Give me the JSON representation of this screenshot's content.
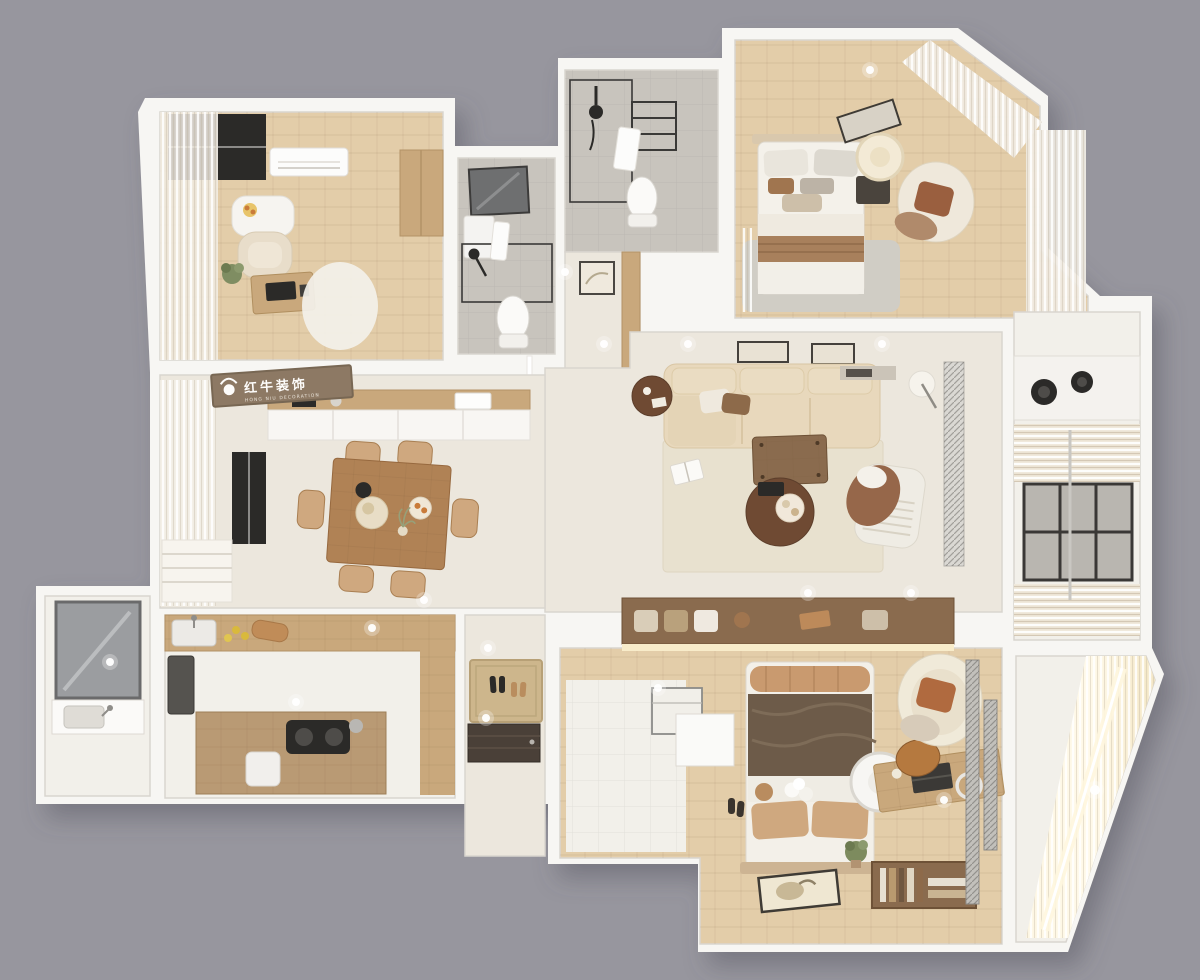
{
  "scene": {
    "type": "3d-floor-plan-top-down-render",
    "canvas_w": 1200,
    "canvas_h": 980,
    "style": "dollhouse cutaway, beige/wood interior on gray backdrop"
  },
  "branding": {
    "logo_text_cn": "红牛装饰",
    "logo_text_en": "HONG NIU DECORATION",
    "logo_icon": "bull-icon",
    "banner_color": "#8d7964"
  },
  "palette": {
    "background": "#97969e",
    "wall": "#f7f6f3",
    "wall_shadow": "#6b6a73",
    "floor_light": "#ece7dd",
    "floor_white": "#f2f0ea",
    "wood_light": "#e3cda9",
    "wood_mid": "#c9a87c",
    "wood_dark": "#8a6b4e",
    "wood_deep": "#6f4a33",
    "tile_gray": "#c8c4bd",
    "rug_beige": "#e8e1cf",
    "rug_gray": "#d0cdc5",
    "sofa_beige": "#e8d8bc",
    "duvet_brown": "#6d5b49",
    "pillow_tan": "#cfa87f",
    "accent_rust": "#b06a3f",
    "glass_dark": "#2b2a28",
    "glow_warm": "#f8ecca",
    "metal_gray": "#c2c0bb"
  },
  "rooms": [
    {
      "id": "study",
      "furniture": [
        "corner-window",
        "sheer-curtains",
        "ac-unit",
        "wall-desk",
        "fruit-bowl",
        "armchair",
        "plant",
        "computer-desk",
        "monitor",
        "fluffy-rug",
        "wardrobe-panel"
      ]
    },
    {
      "id": "bathroom-1",
      "furniture": [
        "mirror",
        "vanity",
        "shower-screen",
        "shower-head",
        "towel",
        "toilet"
      ]
    },
    {
      "id": "bathroom-2",
      "furniture": [
        "shower-head",
        "glass-screen",
        "towel-ladder",
        "towel",
        "toilet"
      ]
    },
    {
      "id": "hallway",
      "furniture": [
        "wall-art-panel",
        "wardrobe-strip",
        "sliding-door-track",
        "downlights"
      ]
    },
    {
      "id": "bedroom-2",
      "furniture": [
        "double-bed",
        "pillows",
        "knit-throw",
        "headboard",
        "tilted-wall-art",
        "paper-lantern-pendant",
        "nightstand",
        "round-armchair",
        "gray-rug",
        "corner-sheer-curtains"
      ]
    },
    {
      "id": "living-room",
      "furniture": [
        "sectional-sofa",
        "throw-pillows",
        "round-side-table",
        "candle",
        "floor-lamp",
        "two-wall-frames",
        "area-rug",
        "wood-coffee-table",
        "round-coffee-table",
        "open-book",
        "ribbed-lounge-chair",
        "draped-throw",
        "vent-panel"
      ]
    },
    {
      "id": "kitchenette-balcony",
      "furniture": [
        "two-burner-cooktop",
        "venetian-blinds",
        "window-grid",
        "drying-pole"
      ]
    },
    {
      "id": "dining-room",
      "furniture": [
        "dining-table",
        "six-chairs",
        "kettle",
        "tea-tray",
        "plate",
        "plant-vase",
        "sideboard",
        "brand-sign",
        "window",
        "sheer-curtains",
        "roman-shades"
      ]
    },
    {
      "id": "kitchen",
      "furniture": [
        "fridge",
        "top-counter",
        "sink",
        "faucet",
        "lemons",
        "cutting-board",
        "island-counter",
        "cooktop",
        "stool"
      ]
    },
    {
      "id": "utility-balcony",
      "furniture": [
        "leaning-window-pane",
        "laundry-sink",
        "faucet"
      ]
    },
    {
      "id": "entry",
      "furniture": [
        "doormat",
        "two-shoe-pairs",
        "two-slippers",
        "entry-door"
      ]
    },
    {
      "id": "master-suite",
      "furniture": [
        "closet-console",
        "led-glow-strip",
        "double-bed",
        "rolled-blanket",
        "dark-duvet",
        "tan-pillows",
        "headboard",
        "leaning-floor-art",
        "pendant-disc",
        "desk",
        "laptop",
        "ring-light",
        "desk-chair",
        "book-shelf",
        "round-armchair",
        "plant",
        "closet-island",
        "mesh-screen-panels",
        "slippers"
      ]
    },
    {
      "id": "sun-balcony",
      "furniture": [
        "lit-sheer-curtain",
        "light-glow"
      ]
    }
  ],
  "lighting": {
    "downlight_count": 16,
    "downlight_color": "#ffffff"
  }
}
